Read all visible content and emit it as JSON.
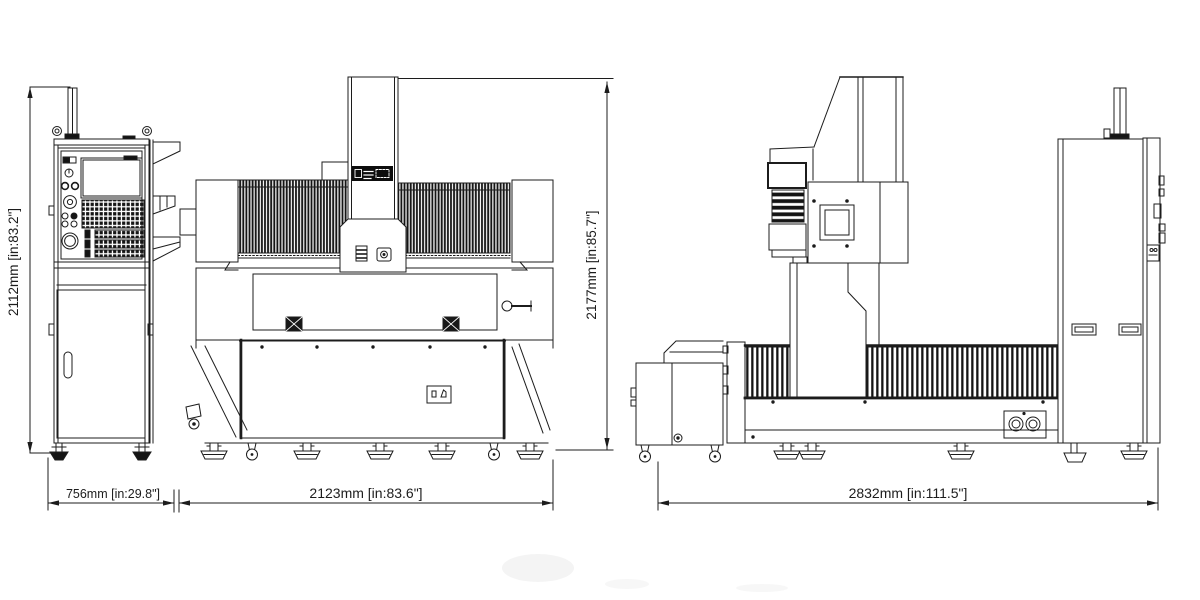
{
  "drawing": {
    "type": "machine-dimension-drawing",
    "background_color": "#ffffff",
    "line_color": "#1c1c1c",
    "dimensions": {
      "pendant_height": "2112mm [in:83.2\"]",
      "pendant_depth": "756mm [in:29.8\"]",
      "front_width": "2123mm [in:83.6\"]",
      "machine_height": "2177mm [in:85.7\"]",
      "side_depth": "2832mm [in:111.5\"]"
    }
  }
}
